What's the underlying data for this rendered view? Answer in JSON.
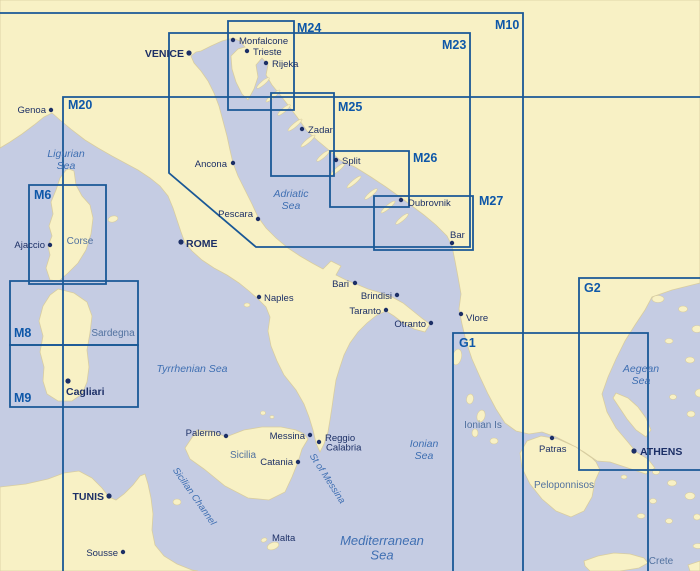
{
  "map": {
    "title": "Mediterranean chart index",
    "colors": {
      "sea": "#c5cce3",
      "land": "#f8f1c5",
      "coast": "#d8cda0",
      "chart_line": "#1a5896",
      "chart_label": "#0e57a8",
      "city": "#1c2f66",
      "sea_label": "#3f6fb2",
      "region_label": "#51719f"
    },
    "charts": [
      {
        "id": "M10",
        "label": "M10",
        "path": "M0,13 H523 V571",
        "label_x": 495,
        "label_y": 29,
        "anchor": "start"
      },
      {
        "id": "M20",
        "label": "M20",
        "path": "M63,571 V97 H700",
        "label_x": 68,
        "label_y": 109,
        "anchor": "start"
      },
      {
        "id": "M23",
        "label": "M23",
        "path": "M169,33 H470 V247 H256 L169,173 Z",
        "label_x": 442,
        "label_y": 49,
        "anchor": "start"
      },
      {
        "id": "M24",
        "label": "M24",
        "path": "M228,21 H294 V110 H228 Z",
        "label_x": 297,
        "label_y": 32,
        "anchor": "start"
      },
      {
        "id": "M25",
        "label": "M25",
        "path": "M271,93 H334 V176 H271 Z",
        "label_x": 338,
        "label_y": 111,
        "anchor": "start"
      },
      {
        "id": "M26",
        "label": "M26",
        "path": "M330,151 H409 V207 H330 Z",
        "label_x": 413,
        "label_y": 162,
        "anchor": "start"
      },
      {
        "id": "M27",
        "label": "M27",
        "path": "M374,196 H473 V250 H374 Z",
        "label_x": 479,
        "label_y": 205,
        "anchor": "start"
      },
      {
        "id": "M6",
        "label": "M6",
        "path": "M29,185 H106 V284 H29 Z",
        "label_x": 34,
        "label_y": 199,
        "anchor": "start"
      },
      {
        "id": "M8",
        "label": "M8",
        "path": "M10,281 H138 V345 H10 Z",
        "label_x": 14,
        "label_y": 337,
        "anchor": "start"
      },
      {
        "id": "M9",
        "label": "M9",
        "path": "M10,345 H138 V407 H10 Z",
        "label_x": 14,
        "label_y": 402,
        "anchor": "start"
      },
      {
        "id": "G1",
        "label": "G1",
        "path": "M453,571 V333 H648 V571",
        "label_x": 459,
        "label_y": 347,
        "anchor": "start"
      },
      {
        "id": "G2",
        "label": "G2",
        "path": "M700,278 H579 V470 H700",
        "label_x": 584,
        "label_y": 292,
        "anchor": "start"
      }
    ],
    "cities": [
      {
        "name": "Monfalcone",
        "dot": [
          233,
          40
        ],
        "lx": 239,
        "ly": 44,
        "anchor": "start"
      },
      {
        "name": "Trieste",
        "dot": [
          247,
          51
        ],
        "lx": 253,
        "ly": 55,
        "anchor": "start"
      },
      {
        "name": "Rijeka",
        "dot": [
          266,
          63
        ],
        "lx": 272,
        "ly": 67,
        "anchor": "start"
      },
      {
        "name": "VENICE",
        "dot": [
          189,
          53
        ],
        "lx": 184,
        "ly": 57,
        "anchor": "end",
        "bold": true
      },
      {
        "name": "Genoa",
        "dot": [
          51,
          110
        ],
        "lx": 46,
        "ly": 113,
        "anchor": "end"
      },
      {
        "name": "Zadar",
        "dot": [
          302,
          129
        ],
        "lx": 308,
        "ly": 133,
        "anchor": "start"
      },
      {
        "name": "Split",
        "dot": [
          336,
          160
        ],
        "lx": 342,
        "ly": 164,
        "anchor": "start"
      },
      {
        "name": "Dubrovnik",
        "dot": [
          401,
          200
        ],
        "lx": 408,
        "ly": 206,
        "anchor": "start"
      },
      {
        "name": "Bar",
        "dot": [
          452,
          243
        ],
        "lx": 450,
        "ly": 238,
        "anchor": "start"
      },
      {
        "name": "Ancona",
        "dot": [
          233,
          163
        ],
        "lx": 227,
        "ly": 167,
        "anchor": "end"
      },
      {
        "name": "Pescara",
        "dot": [
          258,
          219
        ],
        "lx": 253,
        "ly": 217,
        "anchor": "end"
      },
      {
        "name": "ROME",
        "dot": [
          181,
          242
        ],
        "lx": 186,
        "ly": 247,
        "anchor": "start",
        "bold": true
      },
      {
        "name": "Naples",
        "dot": [
          259,
          297
        ],
        "lx": 264,
        "ly": 301,
        "anchor": "start"
      },
      {
        "name": "Bari",
        "dot": [
          355,
          283
        ],
        "lx": 349,
        "ly": 287,
        "anchor": "end"
      },
      {
        "name": "Brindisi",
        "dot": [
          397,
          295
        ],
        "lx": 392,
        "ly": 299,
        "anchor": "end"
      },
      {
        "name": "Taranto",
        "dot": [
          386,
          310
        ],
        "lx": 381,
        "ly": 314,
        "anchor": "end"
      },
      {
        "name": "Otranto",
        "dot": [
          431,
          323
        ],
        "lx": 426,
        "ly": 327,
        "anchor": "end"
      },
      {
        "name": "Vlore",
        "dot": [
          461,
          314
        ],
        "lx": 466,
        "ly": 321,
        "anchor": "start"
      },
      {
        "name": "Ajaccio",
        "dot": [
          50,
          245
        ],
        "lx": 45,
        "ly": 248,
        "anchor": "end"
      },
      {
        "name": "Cagliari",
        "dot": [
          68,
          381
        ],
        "lx": 66,
        "ly": 395,
        "anchor": "start",
        "bold": true
      },
      {
        "name": "Palermo",
        "dot": [
          226,
          436
        ],
        "lx": 221,
        "ly": 436,
        "anchor": "end"
      },
      {
        "name": "Messina",
        "dot": [
          310,
          435
        ],
        "lx": 305,
        "ly": 439,
        "anchor": "end"
      },
      {
        "name": "Reggio Calabria",
        "lines": [
          "Reggio",
          "Calabria"
        ],
        "dot": [
          319,
          442
        ],
        "lx": 325,
        "ly": 441,
        "anchor": "start"
      },
      {
        "name": "Catania",
        "dot": [
          298,
          462
        ],
        "lx": 293,
        "ly": 465,
        "anchor": "end"
      },
      {
        "name": "Patras",
        "dot": [
          552,
          438
        ],
        "lx": 539,
        "ly": 452,
        "anchor": "start"
      },
      {
        "name": "ATHENS",
        "dot": [
          634,
          451
        ],
        "lx": 640,
        "ly": 455,
        "anchor": "start",
        "bold": true
      },
      {
        "name": "TUNIS",
        "dot": [
          109,
          496
        ],
        "lx": 104,
        "ly": 500,
        "anchor": "end",
        "bold": true
      },
      {
        "name": "Sousse",
        "dot": [
          123,
          552
        ],
        "lx": 118,
        "ly": 556,
        "anchor": "end"
      },
      {
        "name": "Malta",
        "dot": null,
        "lx": 272,
        "ly": 541,
        "anchor": "start"
      }
    ],
    "seas": [
      {
        "name": "Ligurian Sea",
        "lines": [
          "Ligurian",
          "Sea"
        ],
        "x": 66,
        "y": 157,
        "size": 10.5,
        "rotate": 0
      },
      {
        "name": "Adriatic Sea",
        "lines": [
          "Adriatic",
          "Sea"
        ],
        "x": 291,
        "y": 197,
        "size": 10.5,
        "rotate": 0
      },
      {
        "name": "Tyrrhenian Sea",
        "lines": [
          "Tyrrhenian Sea"
        ],
        "x": 192,
        "y": 372,
        "size": 10.5,
        "rotate": 0
      },
      {
        "name": "Ionian Sea",
        "lines": [
          "Ionian",
          "Sea"
        ],
        "x": 424,
        "y": 447,
        "size": 10.5,
        "rotate": 0
      },
      {
        "name": "Aegean Sea",
        "lines": [
          "Aegean",
          "Sea"
        ],
        "x": 641,
        "y": 372,
        "size": 10.5,
        "rotate": 0
      },
      {
        "name": "Mediterranean Sea",
        "lines": [
          "Mediterranean",
          "Sea"
        ],
        "x": 382,
        "y": 545,
        "size": 13,
        "rotate": 0
      },
      {
        "name": "Sicilian Channel",
        "lines": [
          "Sicilian  Channel"
        ],
        "x": 192,
        "y": 498,
        "size": 9.5,
        "rotate": 55
      },
      {
        "name": "St of Messina",
        "lines": [
          "St of Messina"
        ],
        "x": 325,
        "y": 480,
        "size": 9.5,
        "rotate": 57
      }
    ],
    "regions": [
      {
        "name": "Corse",
        "x": 80,
        "y": 244
      },
      {
        "name": "Sardegna",
        "x": 113,
        "y": 336
      },
      {
        "name": "Sicilia",
        "x": 243,
        "y": 458
      },
      {
        "name": "Ionian Is",
        "x": 483,
        "y": 428
      },
      {
        "name": "Peloponnisos",
        "x": 564,
        "y": 488
      },
      {
        "name": "Crete",
        "x": 661,
        "y": 564
      }
    ]
  }
}
